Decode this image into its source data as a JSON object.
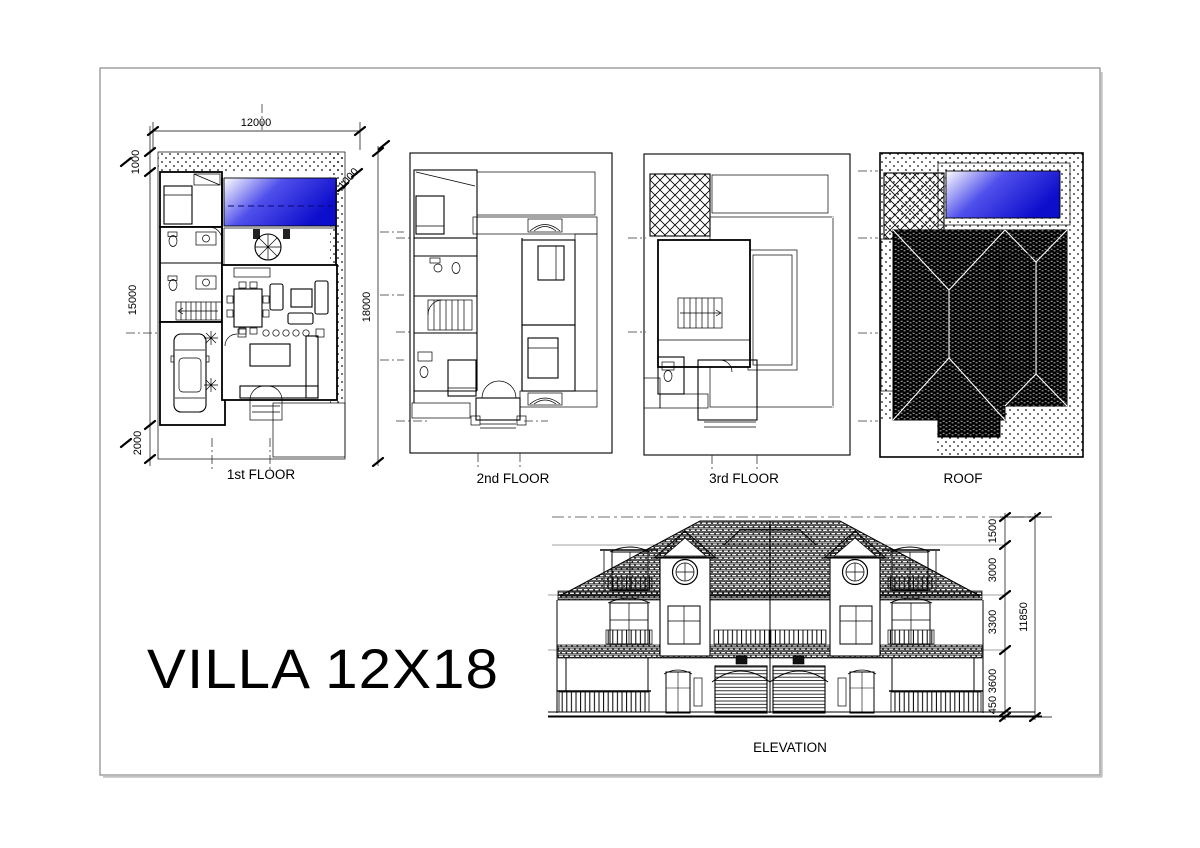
{
  "sheet": {
    "title": "VILLA 12X18"
  },
  "plans": {
    "first": {
      "label": "1st FLOOR",
      "dim_width_top": "12000",
      "dim_offset_top_left": "1000",
      "dim_depth_left": "15000",
      "dim_offset_bottom_left": "2000",
      "dim_depth_right": "18000",
      "dim_pool_offset": "1000"
    },
    "second": {
      "label": "2nd FLOOR"
    },
    "third": {
      "label": "3rd FLOOR"
    },
    "roof": {
      "label": "ROOF"
    }
  },
  "elevation": {
    "label": "ELEVATION",
    "dim_parapet": "1500",
    "dim_third": "3000",
    "dim_second": "3300",
    "dim_first": "3600",
    "dim_plinth": "450",
    "dim_total": "11850"
  },
  "colors": {
    "pool_blue": "#1414d2",
    "ink": "#000000",
    "paper": "#ffffff",
    "sheet_border": "#9a9a9a"
  }
}
